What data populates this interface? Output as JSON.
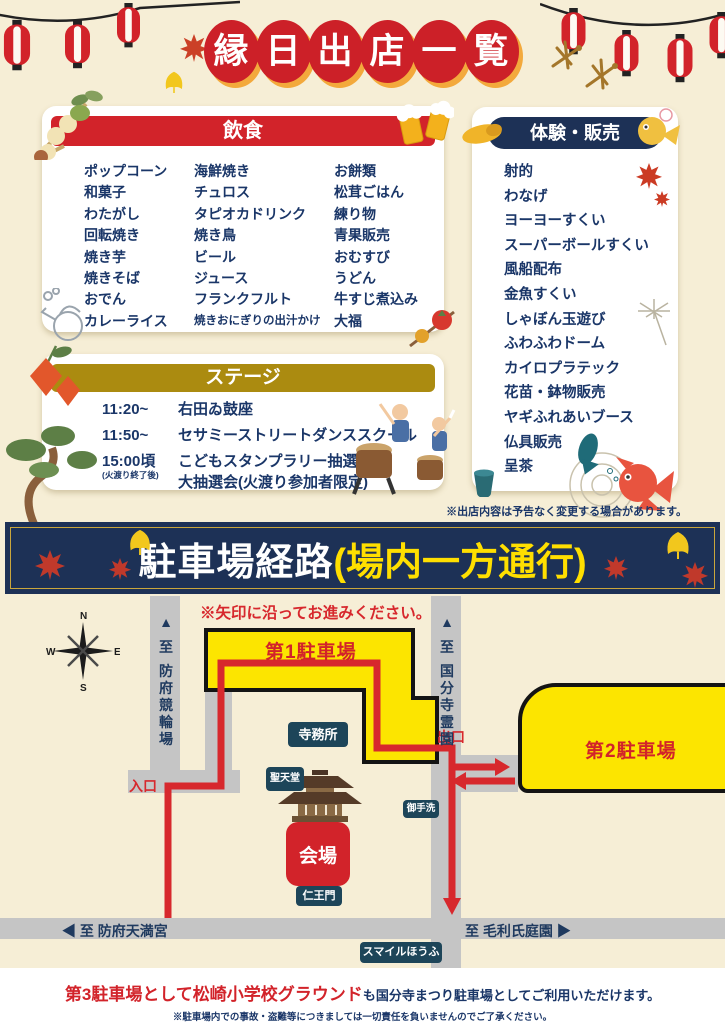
{
  "title": "縁日出店一覧",
  "food": {
    "header": "飲食",
    "columns": [
      [
        "ポップコーン",
        "和菓子",
        "わたがし",
        "回転焼き",
        "焼き芋",
        "焼きそば",
        "おでん",
        "カレーライス"
      ],
      [
        "海鮮焼き",
        "チュロス",
        "タピオカドリンク",
        "焼き鳥",
        "ビール",
        "ジュース",
        "フランクフルト",
        "焼きおにぎりの出汁かけ"
      ],
      [
        "お餅類",
        "松茸ごはん",
        "練り物",
        "青果販売",
        "おむすび",
        "うどん",
        "牛すじ煮込み",
        "大福"
      ]
    ]
  },
  "experience": {
    "header": "体験・販売",
    "items": [
      "射的",
      "わなげ",
      "ヨーヨーすくい",
      "スーパーボールすくい",
      "風船配布",
      "金魚すくい",
      "しゃぼん玉遊び",
      "ふわふわドーム",
      "カイロプラテック",
      "花苗・鉢物販売",
      "ヤギふれあいブース",
      "仏具販売",
      "呈茶"
    ]
  },
  "stage": {
    "header": "ステージ",
    "rows": [
      {
        "time": "11:20~",
        "time_note": "",
        "events": [
          "右田ゐ鼓座"
        ]
      },
      {
        "time": "11:50~",
        "time_note": "",
        "events": [
          "セサミーストリートダンススクール"
        ]
      },
      {
        "time": "15:00頃",
        "time_note": "(火渡り終了後)",
        "events": [
          "こどもスタンプラリー抽選会",
          "大抽選会(火渡り参加者限定)"
        ]
      }
    ]
  },
  "notes": {
    "stalls": "※出店内容は予告なく変更する場合があります。"
  },
  "parking": {
    "title": "駐車場経路",
    "subtitle": "(場内一方通行)"
  },
  "map": {
    "instruction": "※矢印に沿ってお進みください。",
    "compass": {
      "n": "N",
      "e": "E",
      "s": "S",
      "w": "W"
    },
    "labels": {
      "lot1": "第1駐車場",
      "lot2": "第2駐車場",
      "entrance": "入口",
      "exit": "出口",
      "office": "寺務所",
      "shotendo": "聖天堂",
      "otearai": "御手洗",
      "gate": "仁王門",
      "venue": "会場",
      "smile": "スマイルほうふ",
      "to_keirin": "▲ 至 防府競輪場",
      "to_reien": "▲ 至 国分寺霊園",
      "to_tenmangu": "◀ 至 防府天満宮",
      "to_mori": "至 毛利氏庭園 ▶"
    }
  },
  "footer": {
    "line1_red": "第3駐車場として松崎小学校グラウンド",
    "line1_navy": "も国分寺まつり駐車場としてご利用いただけます。",
    "line2": "※駐車場内での事故・盗難等につきましては一切責任を負いませんのでご了承ください。"
  },
  "colors": {
    "background": "#f6eed6",
    "accent_red": "#d2232a",
    "navy": "#1d3156",
    "text_navy": "#1a3668",
    "stage_gold": "#ab8b10",
    "parking_yellow": "#fce500",
    "banner_yellow": "#ffdf00",
    "road_gray": "#c5c5c5",
    "badge_teal": "#1d4559",
    "route_red": "#d7282d",
    "title_shadow_orange": "#f3a93c"
  },
  "icons": [
    "lantern-icon",
    "maple-leaf-icon",
    "ginkgo-leaf-icon",
    "dragonfly-icon",
    "dango-icon",
    "beer-mugs-icon",
    "kettle-icon",
    "tomato-skewer-icon",
    "sweet-potato-icon",
    "goldfish-icon",
    "teal-fish-icon",
    "tea-cup-icon",
    "sparkler-icon",
    "hozuki-icon",
    "pine-tree-icon",
    "taiko-drummers-icon",
    "temple-icon",
    "compass-rose-icon"
  ]
}
